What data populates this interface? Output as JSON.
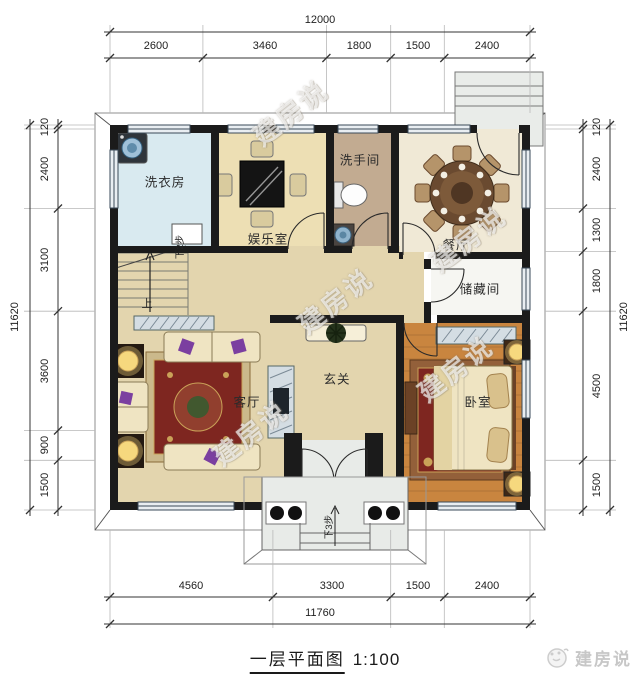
{
  "meta": {
    "title": "一层平面图",
    "scale": "1:100",
    "brand": "建房说",
    "watermark": "建房说"
  },
  "dimensions": {
    "top": {
      "total": "12000",
      "segments": [
        "2600",
        "3460",
        "1800",
        "1500",
        "2400"
      ]
    },
    "left": {
      "total": "11620",
      "segments": [
        "120",
        "2400",
        "3100",
        "3600",
        "900",
        "1500"
      ]
    },
    "right": {
      "total": "11620",
      "segments": [
        "120",
        "2400",
        "1300",
        "1800",
        "4500",
        "1500"
      ]
    },
    "bottom": {
      "total": "11760",
      "segments": [
        "4560",
        "3300",
        "1500",
        "2400"
      ]
    }
  },
  "rooms": {
    "laundry": "洗衣房",
    "entertainment": "娱乐室",
    "washroom": "洗手间",
    "dining": "餐厅",
    "storage": "储藏间",
    "foyer": "玄关",
    "living": "客厅",
    "bedroom": "卧室"
  },
  "annotations": {
    "stairs_up": "上",
    "stairs_down2": "下2步",
    "porch_down3": "下3步"
  },
  "colors": {
    "wall": "#1b1b1b",
    "floor-laundry": "#d9eaf0",
    "floor-entertainment": "#eddfb4",
    "floor-washroom": "#c2ab91",
    "floor-dining": "#f0e9d6",
    "floor-storage": "#f6f6f2",
    "floor-hall": "#e3d5ae",
    "floor-bedroom": "#c9853f",
    "floor-porch": "#e8ebe8",
    "rug-red": "#7e2620",
    "rug-gold": "#caa258",
    "window-line": "#3a4a58",
    "dim-text": "#222222",
    "brand-gray": "#c7c7c7"
  }
}
